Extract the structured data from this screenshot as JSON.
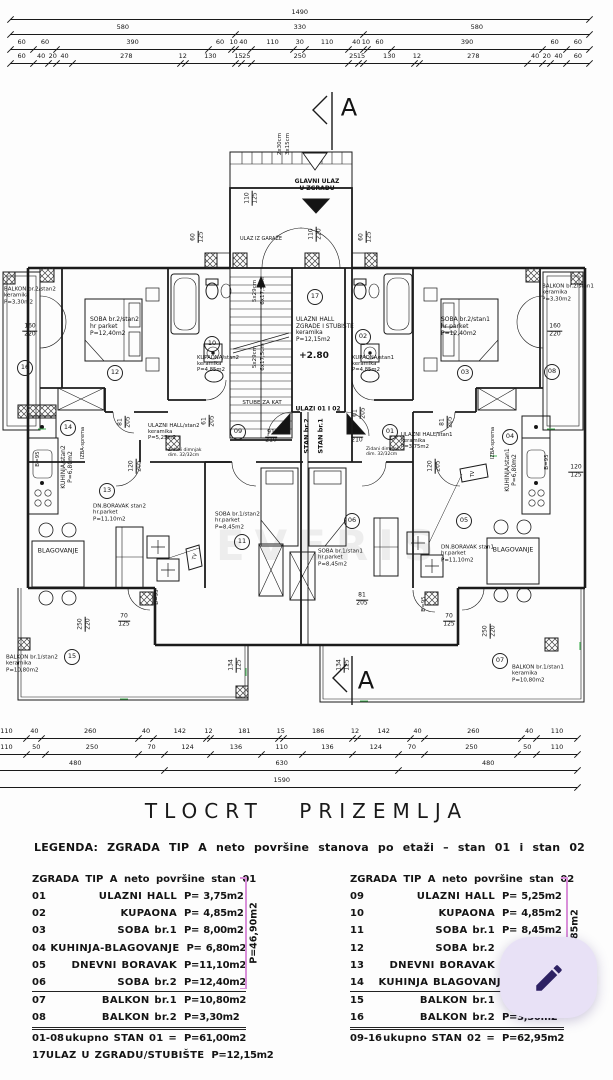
{
  "title": "TLOCRT PRIZEMLJA",
  "legend": {
    "heading": "LEGENDA: ZGRADA TIP A neto površine stanova po etaži – stan 01 i stan 02",
    "left": {
      "header": "ZGRADA TIP A neto površine stan 01",
      "bracket_total": "P=46,90m2",
      "rows": [
        {
          "no": "01",
          "name": "ULAZNI HALL",
          "area": "P= 3,75m2"
        },
        {
          "no": "02",
          "name": "KUPAONA",
          "area": "P= 4,85m2"
        },
        {
          "no": "03",
          "name": "SOBA br.1",
          "area": "P= 8,00m2"
        },
        {
          "no": "04",
          "name": "KUHINJA-BLAGOVANJE",
          "area": "P= 6,80m2"
        },
        {
          "no": "05",
          "name": "DNEVNI BORAVAK",
          "area": "P=11,10m2"
        },
        {
          "no": "06",
          "name": "SOBA br.2",
          "area": "P=12,40m2"
        },
        {
          "no": "07",
          "name": "BALKON br.1",
          "area": "P=10,80m2",
          "sep": "single"
        },
        {
          "no": "08",
          "name": "BALKON br.2",
          "area": "P=3,30m2"
        },
        {
          "no": "01-08",
          "name": "ukupno STAN 01 =",
          "area": "P=61,00m2",
          "sep": "double"
        },
        {
          "no": "17",
          "name": "ULAZ U ZGRADU/STUBIŠTE",
          "area": "P=12,15m2"
        }
      ]
    },
    "right": {
      "header": "ZGRADA TIP A neto površine stan 02",
      "bracket_total": "P=48,85m2",
      "rows": [
        {
          "no": "09",
          "name": "ULAZNI HALL",
          "area": "P= 5,25m2"
        },
        {
          "no": "10",
          "name": "KUPAONA",
          "area": "P= 4,85m2"
        },
        {
          "no": "11",
          "name": "SOBA br.1",
          "area": "P= 8,45m2"
        },
        {
          "no": "12",
          "name": "SOBA br.2",
          "area": ""
        },
        {
          "no": "13",
          "name": "DNEVNI BORAVAK",
          "area": ""
        },
        {
          "no": "14",
          "name": "KUHINJA BLAGOVANJE",
          "area": ""
        },
        {
          "no": "15",
          "name": "BALKON br.1",
          "area": "",
          "sep": "single"
        },
        {
          "no": "16",
          "name": "BALKON br.2",
          "area": "P=3,30m2"
        },
        {
          "no": "09-16",
          "name": "ukupno STAN 02 =",
          "area": "P=62,95m2",
          "sep": "double"
        }
      ]
    }
  },
  "fab": {
    "icon": "pencil-icon",
    "bg": "#e8e1f6",
    "fg": "#2d2163"
  },
  "plan": {
    "section_marker": "A",
    "watermark": "EVERIS",
    "dim_rows": [
      {
        "y": 12,
        "x0": 10,
        "s": 0.389,
        "vals": [
          1490
        ]
      },
      {
        "y": 27,
        "x0": 10,
        "s": 0.389,
        "vals": [
          580,
          330,
          580
        ]
      },
      {
        "y": 42,
        "x0": 10,
        "s": 0.389,
        "vals": [
          60,
          60,
          390,
          60,
          10,
          40,
          110,
          30,
          110,
          40,
          10,
          60,
          390,
          60,
          60
        ]
      },
      {
        "y": 56,
        "x0": 10,
        "s": 0.389,
        "vals": [
          60,
          40,
          20,
          40,
          278,
          12,
          130,
          15,
          25,
          250,
          25,
          15,
          130,
          12,
          278,
          40,
          20,
          40,
          60
        ]
      },
      {
        "y": 731,
        "x0": -14,
        "s": 0.372,
        "vals": [
          110,
          40,
          260,
          40,
          142,
          12,
          181,
          15,
          186,
          12,
          142,
          40,
          260,
          40,
          110
        ]
      },
      {
        "y": 747,
        "x0": -14,
        "s": 0.372,
        "vals": [
          110,
          50,
          250,
          70,
          124,
          136,
          110,
          136,
          124,
          70,
          250,
          50,
          110
        ]
      },
      {
        "y": 763,
        "x0": -14,
        "s": 0.372,
        "vals": [
          480,
          630,
          480
        ]
      },
      {
        "y": 780,
        "x0": -14,
        "s": 0.372,
        "vals": [
          1590
        ]
      }
    ],
    "labels": [
      {
        "t": "A",
        "x": 349,
        "y": 108,
        "s": 24
      },
      {
        "t": "A",
        "x": 366,
        "y": 681,
        "s": 24
      },
      {
        "t": "GLAVNI ULAZ\nU ZGRADU",
        "x": 317,
        "y": 186,
        "s": 6,
        "b": 1
      },
      {
        "t": "2x30cm",
        "x": 280,
        "y": 144,
        "s": 5.5,
        "r": -90
      },
      {
        "t": "3x15cm",
        "x": 288,
        "y": 144,
        "s": 5.5,
        "r": -90
      },
      {
        "t": "ULAZ IZ GARAŽE",
        "x": 261,
        "y": 240,
        "s": 5
      },
      {
        "t": "110",
        "t2": "125",
        "x": 252,
        "y": 198,
        "r": -90,
        "cls": "frac",
        "s": 6
      },
      {
        "t": "110",
        "t2": "220",
        "x": 316,
        "y": 234,
        "r": -90,
        "cls": "frac",
        "s": 6
      },
      {
        "t": "60",
        "t2": "125",
        "x": 198,
        "y": 237,
        "r": -90,
        "cls": "frac",
        "s": 6
      },
      {
        "t": "60",
        "t2": "125",
        "x": 366,
        "y": 237,
        "r": -90,
        "cls": "frac",
        "s": 6
      },
      {
        "t": "5x29cm",
        "x": 255,
        "y": 291,
        "s": 5.5,
        "r": -90
      },
      {
        "t": "6x17,5cm",
        "x": 263,
        "y": 291,
        "s": 5.5,
        "r": -90
      },
      {
        "t": "5x29cm",
        "x": 255,
        "y": 357,
        "s": 5.5,
        "r": -90
      },
      {
        "t": "6x17,5cm",
        "x": 263,
        "y": 357,
        "s": 5.5,
        "r": -90
      },
      {
        "t": "17",
        "x": 315,
        "y": 297,
        "cls": "circ",
        "s": 6.5
      },
      {
        "t": "ULAZNI HALL\nZGRADE I STUBIŠTE\nkeramika\nP=12,15m2",
        "x": 296,
        "y": 330,
        "s": 5.8,
        "al": "l"
      },
      {
        "t": "+2.80",
        "x": 314,
        "y": 356,
        "s": 9,
        "b": 1
      },
      {
        "t": "STUBE ZA KAT",
        "x": 262,
        "y": 403,
        "s": 5.5
      },
      {
        "t": "ULAZI 01 I 02",
        "x": 318,
        "y": 410,
        "s": 6,
        "b": 1
      },
      {
        "t": "BALKON br.2/stan2\nkeramika\nP=3,30m2",
        "x": 4,
        "y": 296,
        "s": 5.5,
        "al": "l"
      },
      {
        "t": "160",
        "t2": "220",
        "x": 30,
        "y": 331,
        "cls": "frac",
        "s": 6
      },
      {
        "t": "16",
        "x": 25,
        "y": 368,
        "cls": "circ",
        "s": 6.5
      },
      {
        "t": "SOBA br.2/stan2\nhr parket\nP=12,40m2",
        "x": 90,
        "y": 327,
        "s": 6,
        "al": "l"
      },
      {
        "t": "12",
        "x": 115,
        "y": 373,
        "cls": "circ",
        "s": 6.5
      },
      {
        "t": "KUPAONA/stan2\nkeramika\nP=4,85m2",
        "x": 197,
        "y": 364,
        "s": 5.3,
        "al": "l"
      },
      {
        "t": "10",
        "x": 212,
        "y": 344,
        "cls": "circ",
        "s": 6.5
      },
      {
        "t": "KUPAONA/stan1\nkeramika\nP=4,85m2",
        "x": 352,
        "y": 364,
        "s": 5.3,
        "al": "l"
      },
      {
        "t": "02",
        "x": 363,
        "y": 337,
        "cls": "circ",
        "s": 6.5
      },
      {
        "t": "SOBA br.2/stan1\nhr parket\nP=12,40m2",
        "x": 441,
        "y": 327,
        "s": 6,
        "al": "l"
      },
      {
        "t": "03",
        "x": 465,
        "y": 373,
        "cls": "circ",
        "s": 6.5
      },
      {
        "t": "BALKON br.2/stan1\nkeramika\nP=3,30m2",
        "x": 542,
        "y": 293,
        "s": 5.5,
        "al": "l"
      },
      {
        "t": "160",
        "t2": "220",
        "x": 555,
        "y": 331,
        "cls": "frac",
        "s": 6
      },
      {
        "t": "08",
        "x": 552,
        "y": 372,
        "cls": "circ",
        "s": 6.5
      },
      {
        "t": "81",
        "t2": "205",
        "x": 125,
        "y": 422,
        "r": -90,
        "cls": "frac",
        "s": 6
      },
      {
        "t": "81",
        "t2": "205",
        "x": 447,
        "y": 422,
        "r": -90,
        "cls": "frac",
        "s": 6
      },
      {
        "t": "61",
        "t2": "205",
        "x": 209,
        "y": 421,
        "r": -90,
        "cls": "frac",
        "s": 6
      },
      {
        "t": "61",
        "t2": "205",
        "x": 360,
        "y": 413,
        "r": -90,
        "cls": "frac",
        "s": 6
      },
      {
        "t": "91",
        "t2": "210",
        "x": 271,
        "y": 437,
        "cls": "frac",
        "s": 6
      },
      {
        "t": "91",
        "t2": "210",
        "x": 357,
        "y": 437,
        "cls": "frac",
        "s": 6
      },
      {
        "t": "STAN br.2",
        "x": 307,
        "y": 436,
        "s": 6.5,
        "b": 1,
        "r": -90
      },
      {
        "t": "STAN br.1",
        "x": 321,
        "y": 436,
        "s": 6.5,
        "b": 1,
        "r": -90
      },
      {
        "t": "09",
        "x": 238,
        "y": 432,
        "cls": "circ",
        "s": 6.5
      },
      {
        "t": "01",
        "x": 390,
        "y": 432,
        "cls": "circ",
        "s": 6.5
      },
      {
        "t": "ULAZNI HALL/stan2\nkeramika\nP=5,25m2",
        "x": 148,
        "y": 432,
        "s": 5.3,
        "al": "l"
      },
      {
        "t": "Zidani dimnjak\ndim. 32/32cm",
        "x": 168,
        "y": 453,
        "s": 4.5,
        "al": "l"
      },
      {
        "t": "ULAZNI HALL/stan1\nkeramika\nP=3,75m2",
        "x": 401,
        "y": 441,
        "s": 5.3,
        "al": "l"
      },
      {
        "t": "Zidani dimnjak\ndim. 32/32cm",
        "x": 366,
        "y": 452,
        "s": 4.5,
        "al": "l"
      },
      {
        "t": "IZBA-sprema",
        "x": 84,
        "y": 443,
        "s": 5,
        "r": -90
      },
      {
        "t": "IZBA-sprema",
        "x": 494,
        "y": 443,
        "s": 5,
        "r": -90
      },
      {
        "t": "14",
        "x": 68,
        "y": 428,
        "cls": "circ",
        "s": 6.5
      },
      {
        "t": "04",
        "x": 510,
        "y": 437,
        "cls": "circ",
        "s": 6.5
      },
      {
        "t": "KUHINJA/stan2\nP=6,80m2",
        "x": 68,
        "y": 467,
        "s": 6,
        "r": -90
      },
      {
        "t": "KUHINJA/stan1\nP=6,80m2",
        "x": 512,
        "y": 470,
        "s": 6,
        "r": -90
      },
      {
        "t": "B=95",
        "x": 38,
        "y": 459,
        "s": 5.5,
        "r": -90
      },
      {
        "t": "B=95",
        "x": 547,
        "y": 462,
        "s": 5.5,
        "r": -90
      },
      {
        "t": "B=95",
        "x": 157,
        "y": 597,
        "s": 5.5,
        "r": -90
      },
      {
        "t": "B=95",
        "x": 424,
        "y": 604,
        "s": 5.5,
        "r": -90
      },
      {
        "t": "120",
        "t2": "205",
        "x": 136,
        "y": 466,
        "r": -90,
        "cls": "frac",
        "s": 6
      },
      {
        "t": "120",
        "t2": "205",
        "x": 435,
        "y": 466,
        "r": -90,
        "cls": "frac",
        "s": 6
      },
      {
        "t": "120",
        "t2": "125",
        "x": 576,
        "y": 472,
        "cls": "frac",
        "s": 6
      },
      {
        "t": "13",
        "x": 107,
        "y": 491,
        "cls": "circ",
        "s": 6.5
      },
      {
        "t": "05",
        "x": 464,
        "y": 521,
        "cls": "circ",
        "s": 6.5
      },
      {
        "t": "DN.BORAVAK stan2\nhr.parket\nP=11,10m2",
        "x": 93,
        "y": 513,
        "s": 5.5,
        "al": "l"
      },
      {
        "t": "DN.BORAVAK stan1\nhr.parket\nP=11,10m2",
        "x": 441,
        "y": 554,
        "s": 5.5,
        "al": "l"
      },
      {
        "t": "11",
        "x": 242,
        "y": 542,
        "cls": "circ",
        "s": 6.5
      },
      {
        "t": "06",
        "x": 352,
        "y": 521,
        "cls": "circ",
        "s": 6.5
      },
      {
        "t": "SOBA br.1/stan2\nhr.parket\nP=8,45m2",
        "x": 215,
        "y": 521,
        "s": 5.5,
        "al": "l"
      },
      {
        "t": "SOBA br.1/stan1\nhr.parket\nP=8,45m2",
        "x": 318,
        "y": 558,
        "s": 5.5,
        "al": "l"
      },
      {
        "t": "BLAGOVANJE",
        "x": 58,
        "y": 551,
        "s": 6.3
      },
      {
        "t": "BLAGOVANJE",
        "x": 513,
        "y": 550,
        "s": 6.3
      },
      {
        "t": "TV",
        "x": 196,
        "y": 557,
        "s": 5,
        "r": -75
      },
      {
        "t": "TV",
        "x": 474,
        "y": 474,
        "s": 5,
        "r": -90
      },
      {
        "t": "70",
        "t2": "125",
        "x": 124,
        "y": 621,
        "cls": "frac",
        "s": 6
      },
      {
        "t": "70",
        "t2": "125",
        "x": 449,
        "y": 621,
        "cls": "frac",
        "s": 6
      },
      {
        "t": "250",
        "t2": "220",
        "x": 85,
        "y": 624,
        "r": -90,
        "cls": "frac",
        "s": 6
      },
      {
        "t": "250",
        "t2": "220",
        "x": 490,
        "y": 631,
        "r": -90,
        "cls": "frac",
        "s": 6
      },
      {
        "t": "134",
        "t2": "125",
        "x": 236,
        "y": 665,
        "r": -90,
        "cls": "frac",
        "s": 6
      },
      {
        "t": "134",
        "t2": "125",
        "x": 344,
        "y": 665,
        "r": -90,
        "cls": "frac",
        "s": 6
      },
      {
        "t": "81",
        "t2": "205",
        "x": 362,
        "y": 600,
        "cls": "frac",
        "s": 6
      },
      {
        "t": "15",
        "x": 72,
        "y": 657,
        "cls": "circ",
        "s": 6.5
      },
      {
        "t": "07",
        "x": 500,
        "y": 661,
        "cls": "circ",
        "s": 6.5
      },
      {
        "t": "BALKON br.1/stan2\nkeramika\nP=10,80m2",
        "x": 6,
        "y": 664,
        "s": 5.5,
        "al": "l"
      },
      {
        "t": "BALKON br.1/stan1\nkeramika\nP=10,80m2",
        "x": 512,
        "y": 674,
        "s": 5.5,
        "al": "l"
      },
      {
        "t": "EVERIS",
        "x": 330,
        "y": 546,
        "s": 42,
        "b": 1,
        "c": "rgba(100,100,100,0.10)",
        "ls": 10,
        "n": "watermark"
      }
    ]
  }
}
